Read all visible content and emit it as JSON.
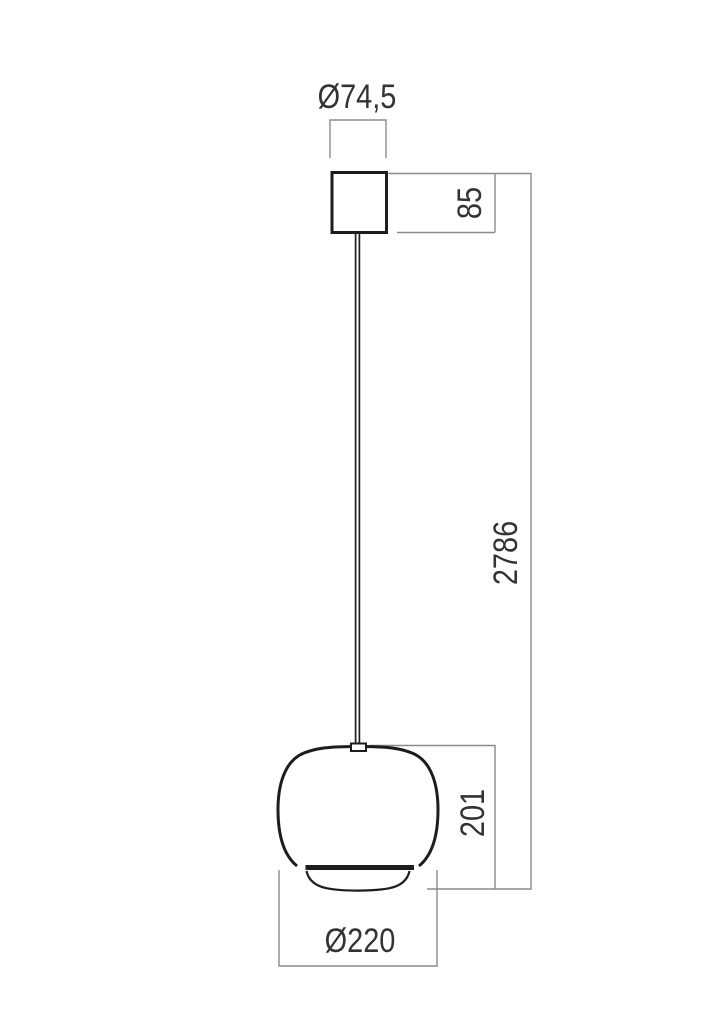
{
  "drawing": {
    "kind": "pendant-lamp-dimension-drawing",
    "labels": {
      "canopy_diameter": "Ø74,5",
      "canopy_height": "85",
      "suspension_length": "2786",
      "shade_height": "201",
      "shade_diameter": "Ø220"
    },
    "colors": {
      "outline": "#1d1d1d",
      "dimension_line": "#8b8b8b",
      "label_text": "#333333",
      "background": "#ffffff"
    }
  }
}
